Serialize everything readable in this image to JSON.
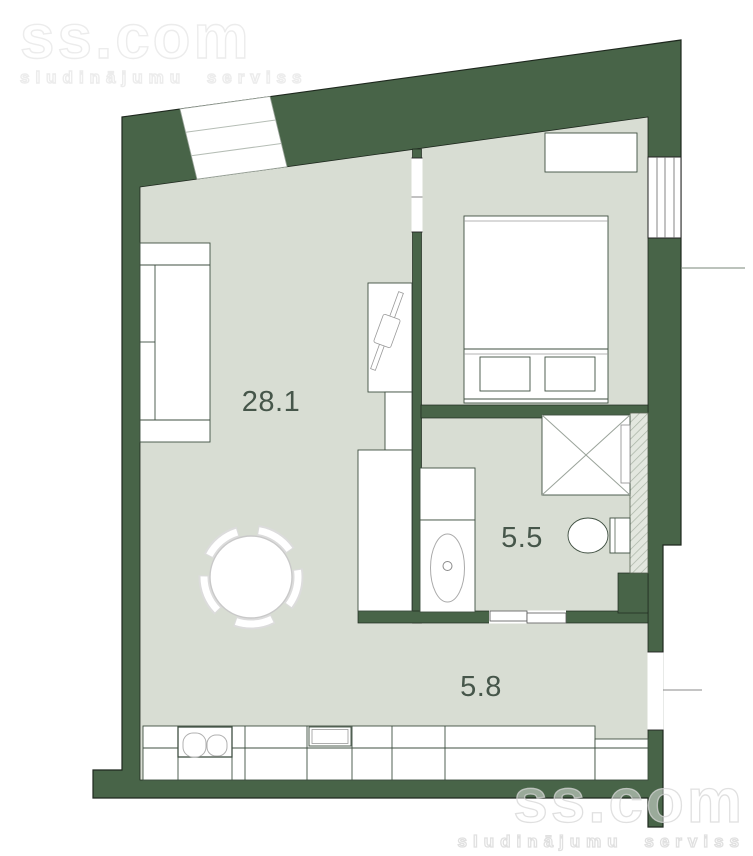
{
  "watermark": {
    "brand": "ss.com",
    "tagline": "sludinājumu serviss"
  },
  "rooms": {
    "living": {
      "name": "living-room-kitchen",
      "area": "28.1"
    },
    "bathroom": {
      "name": "bathroom",
      "area": "5.5"
    },
    "hallway": {
      "name": "hallway",
      "area": "5.8"
    }
  },
  "colors": {
    "wall": "#486448",
    "floor": "#d8ddd3",
    "furniture_fill": "#ffffff",
    "furniture_stroke": "#3f4f41",
    "label_text": "#46564a",
    "watermark_gray": "#e2e2e2",
    "background": "#ffffff"
  }
}
